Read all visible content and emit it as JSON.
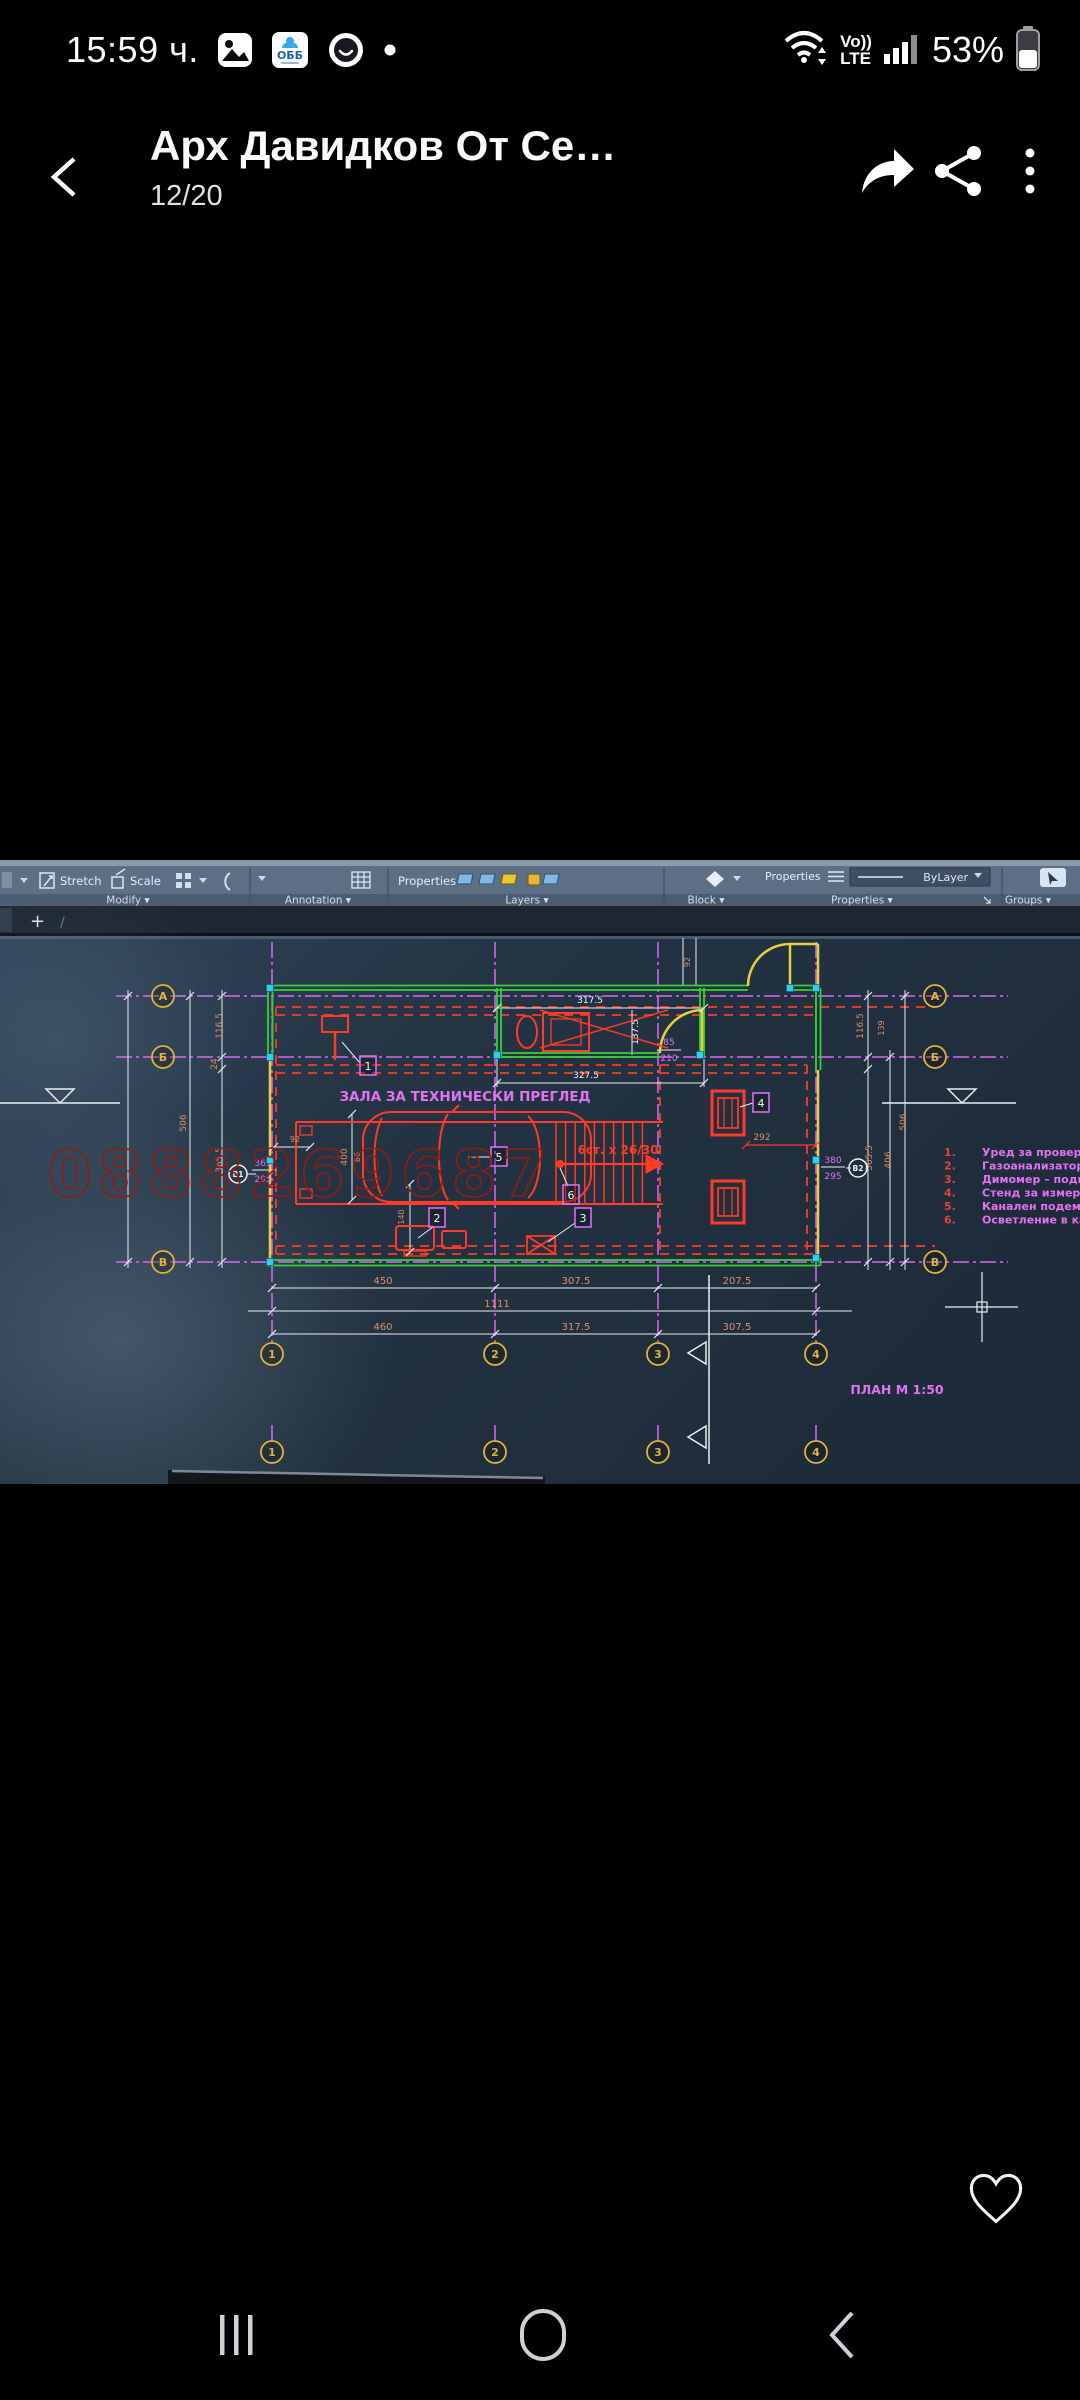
{
  "status_bar": {
    "time": "15:59 ч.",
    "obb": "ОББ",
    "volte_top": "Vo))",
    "volte_bottom": "LTE",
    "battery_percent": "53%"
  },
  "header": {
    "title": "Арх Давидков От Се…",
    "counter": "12/20"
  },
  "photo": {
    "ribbon": {
      "stretch": "Stretch",
      "scale": "Scale",
      "modify": "Modify ▾",
      "annotation": "Annotation ▾",
      "properties_row": "Properties",
      "layers": "Layers ▾",
      "block": "Block ▾",
      "properties_label": "Properties",
      "bylayer": "ByLayer",
      "properties_panel": "Properties ▾",
      "groups": "Groups ▾",
      "new_tab": "+",
      "tab_slash": "/"
    },
    "drawing": {
      "room_title": "ЗАЛА ЗА ТЕХНИЧЕСКИ ПРЕГЛЕД",
      "plan_label": "ПЛАН М 1:50",
      "stairs_label": "6ст. х 26/30",
      "watermark": "0888269687",
      "colors": {
        "o": "#dd9066",
        "w": "#eef2f4",
        "m": "#e272f2",
        "r": "#ff3a26",
        "yellow": "#e3b13d",
        "green": "#34d334",
        "grid": "#d46cf2",
        "red_num": "#e04438"
      },
      "legend": [
        {
          "num": "1.",
          "text": "Уред за проверка р"
        },
        {
          "num": "2.",
          "text": "Газоанализатор – п"
        },
        {
          "num": "3.",
          "text": "Димомер – подвижн"
        },
        {
          "num": "4.",
          "text": "Стенд за измерване"
        },
        {
          "num": "5.",
          "text": "Канален подемник -"
        },
        {
          "num": "6.",
          "text": "Осветление в канал"
        }
      ],
      "axis_bubbles": [
        {
          "x": 163,
          "y": 136,
          "label": "А"
        },
        {
          "x": 163,
          "y": 197,
          "label": "Б"
        },
        {
          "x": 163,
          "y": 402,
          "label": "В"
        },
        {
          "x": 935,
          "y": 136,
          "label": "А"
        },
        {
          "x": 935,
          "y": 197,
          "label": "Б"
        },
        {
          "x": 935,
          "y": 402,
          "label": "В"
        },
        {
          "x": 272,
          "y": 494,
          "label": "1"
        },
        {
          "x": 495,
          "y": 494,
          "label": "2"
        },
        {
          "x": 658,
          "y": 494,
          "label": "3"
        },
        {
          "x": 816,
          "y": 494,
          "label": "4"
        },
        {
          "x": 272,
          "y": 592,
          "label": "1"
        },
        {
          "x": 495,
          "y": 592,
          "label": "2"
        },
        {
          "x": 658,
          "y": 592,
          "label": "3"
        },
        {
          "x": 816,
          "y": 592,
          "label": "4"
        }
      ],
      "ref_circles": [
        {
          "x": 238,
          "y": 314,
          "label": "В1"
        },
        {
          "x": 858,
          "y": 308,
          "label": "В2"
        }
      ],
      "callouts": [
        {
          "x": 368,
          "y": 206,
          "label": "1"
        },
        {
          "x": 437,
          "y": 358,
          "label": "2"
        },
        {
          "x": 583,
          "y": 358,
          "label": "3"
        },
        {
          "x": 761,
          "y": 243,
          "label": "4"
        },
        {
          "x": 499,
          "y": 297,
          "label": "5"
        },
        {
          "x": 571,
          "y": 335,
          "label": "6"
        }
      ],
      "dim_labels": [
        {
          "x": 222,
          "y": 166,
          "t": "116.5",
          "c": "o",
          "r": -90
        },
        {
          "x": 217,
          "y": 204,
          "t": "24",
          "c": "o",
          "r": -90
        },
        {
          "x": 222,
          "y": 300,
          "t": "365.5",
          "c": "o",
          "r": -90
        },
        {
          "x": 186,
          "y": 263,
          "t": "506",
          "c": "o",
          "r": -90
        },
        {
          "x": 263,
          "y": 306,
          "t": "365",
          "c": "m"
        },
        {
          "x": 263,
          "y": 322,
          "t": "295",
          "c": "m"
        },
        {
          "x": 295,
          "y": 282,
          "t": "92",
          "c": "o",
          "fs": 8
        },
        {
          "x": 347,
          "y": 297,
          "t": "400",
          "c": "o",
          "r": -90
        },
        {
          "x": 360,
          "y": 297,
          "t": "86",
          "c": "o",
          "r": -90,
          "fs": 8
        },
        {
          "x": 404,
          "y": 357,
          "t": "140",
          "c": "o",
          "r": -90,
          "fs": 8
        },
        {
          "x": 762,
          "y": 280,
          "t": "292",
          "c": "o",
          "fs": 9
        },
        {
          "x": 590,
          "y": 143,
          "t": "317.5",
          "c": "w"
        },
        {
          "x": 638,
          "y": 172,
          "t": "137.5",
          "c": "w",
          "r": -90
        },
        {
          "x": 669,
          "y": 185,
          "t": "85",
          "c": "m"
        },
        {
          "x": 669,
          "y": 201,
          "t": "210",
          "c": "m"
        },
        {
          "x": 586,
          "y": 218,
          "t": "327.5",
          "c": "w"
        },
        {
          "x": 690,
          "y": 102,
          "t": "92",
          "c": "o",
          "r": -90,
          "fs": 8
        },
        {
          "x": 833,
          "y": 303,
          "t": "380",
          "c": "m"
        },
        {
          "x": 833,
          "y": 319,
          "t": "295",
          "c": "m"
        },
        {
          "x": 863,
          "y": 166,
          "t": "116.5",
          "c": "o",
          "r": -90
        },
        {
          "x": 884,
          "y": 168,
          "t": "139",
          "c": "o",
          "r": -90,
          "fs": 8
        },
        {
          "x": 872,
          "y": 298,
          "t": "365.5",
          "c": "o",
          "r": -90
        },
        {
          "x": 891,
          "y": 300,
          "t": "406",
          "c": "o",
          "r": -90
        },
        {
          "x": 906,
          "y": 262,
          "t": "506",
          "c": "o",
          "r": -90
        },
        {
          "x": 383,
          "y": 424,
          "t": "450",
          "c": "o",
          "fs": 10
        },
        {
          "x": 576,
          "y": 424,
          "t": "307.5",
          "c": "o",
          "fs": 10
        },
        {
          "x": 737,
          "y": 424,
          "t": "207.5",
          "c": "o",
          "fs": 10
        },
        {
          "x": 497,
          "y": 447,
          "t": "1111",
          "c": "o",
          "fs": 10
        },
        {
          "x": 383,
          "y": 470,
          "t": "460",
          "c": "o",
          "fs": 10
        },
        {
          "x": 576,
          "y": 470,
          "t": "317.5",
          "c": "o",
          "fs": 10
        },
        {
          "x": 737,
          "y": 470,
          "t": "307.5",
          "c": "o",
          "fs": 10
        }
      ]
    }
  }
}
